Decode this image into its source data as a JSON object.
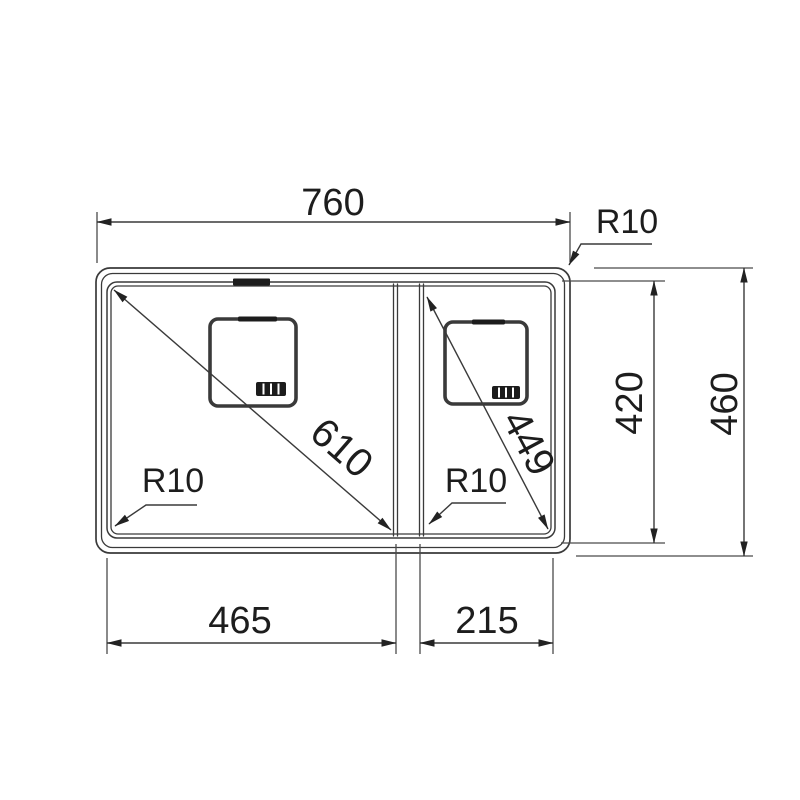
{
  "page": {
    "background": "#ffffff"
  },
  "drawing": {
    "line_color": "#3a3a3a",
    "thin_color": "#4a4a4a",
    "ink_color": "#1c1c1c",
    "text_color": "#1d1d1d",
    "arrow_color": "#222222",
    "labels": {
      "overall_width": "760",
      "overall_depth": "460",
      "bowl_depth": "420",
      "main_bowl_width": "465",
      "small_bowl_width": "215",
      "main_bowl_diagonal": "610",
      "small_bowl_diagonal": "449",
      "outer_corner_radius": "R10",
      "main_bowl_corner_radius": "R10",
      "small_bowl_corner_radius": "R10"
    }
  }
}
